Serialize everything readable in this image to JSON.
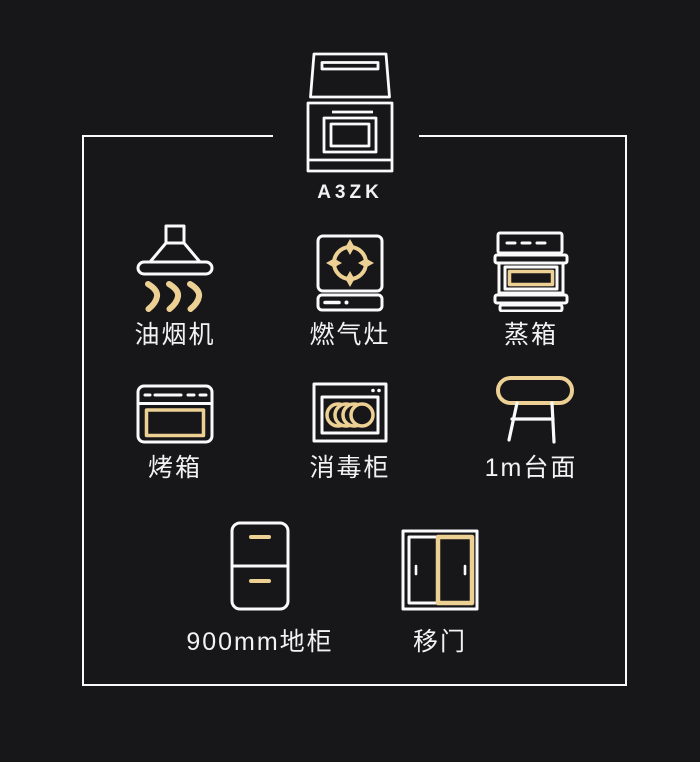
{
  "colors": {
    "background": "#17171a",
    "line": "#fafafa",
    "accent": "#ecd094"
  },
  "model": {
    "label": "A3ZK",
    "icon": "integrated-stove-icon"
  },
  "items": [
    {
      "label": "油烟机",
      "icon": "range-hood-icon"
    },
    {
      "label": "燃气灶",
      "icon": "gas-stove-icon"
    },
    {
      "label": "蒸箱",
      "icon": "steam-oven-icon"
    },
    {
      "label": "烤箱",
      "icon": "oven-icon"
    },
    {
      "label": "消毒柜",
      "icon": "disinfection-cabinet-icon"
    },
    {
      "label": "1m台面",
      "icon": "countertop-icon"
    },
    {
      "label": "900mm地柜",
      "icon": "base-cabinet-icon"
    },
    {
      "label": "移门",
      "icon": "sliding-door-icon"
    }
  ]
}
